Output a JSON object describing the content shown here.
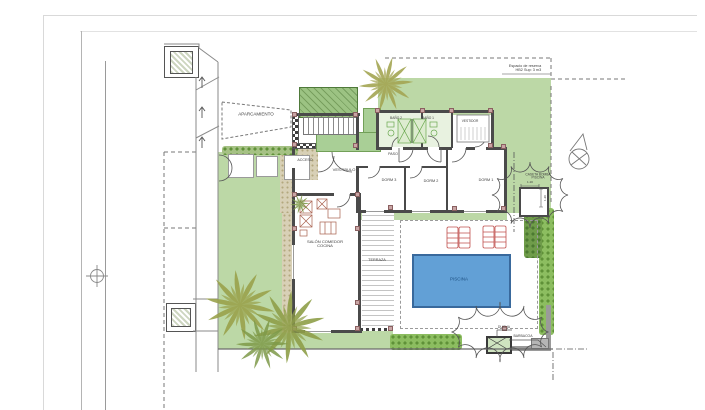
{
  "document_type": "architectural site and floor plan",
  "rooms": {
    "aparcamiento": "APARCAMIENTO",
    "acceso": "ACCESO",
    "vestibulo": "VESTIBULO",
    "paso": "PASO",
    "bano2": "BAÑO 2",
    "bano1": "BAÑO 1",
    "vestidor": "VESTIDOR",
    "dorm3": "DORM 3",
    "dorm2": "DORM 2",
    "dorm1": "DORM 1",
    "salon_line1": "SALÓN COMEDOR",
    "salon_line2": "COCINA",
    "terraza": "TERRAZA",
    "piscina": "PISCINA",
    "caseta_line1": "CASETA BOMBA",
    "caseta_line2": "PISCINA",
    "ducha": "DUCHA",
    "barbacoa": "BARBACOA"
  },
  "site": {
    "reserva_line1": "Espacio de reserva",
    "reserva_line2": "HB2 Sup: 3 m3"
  },
  "dimensions": {
    "caseta_width": "1.20",
    "caseta_height": "1.20"
  },
  "colors": {
    "garden_green": "#bcd8a6",
    "lawn_green": "#a9cf96",
    "hedge_green": "#8cbd60",
    "pool_water": "#62a0d6",
    "pool_text": "#1d4f80",
    "path_sand": "#d8d0b6",
    "wall_gray": "#4a4a4a",
    "fence_gray": "#9a9a9a",
    "lounger_red": "#c0504d",
    "fixture_green": "#6aa84f",
    "column_pink": "#c9a5a5",
    "palm_olive": "#9aa24c"
  }
}
